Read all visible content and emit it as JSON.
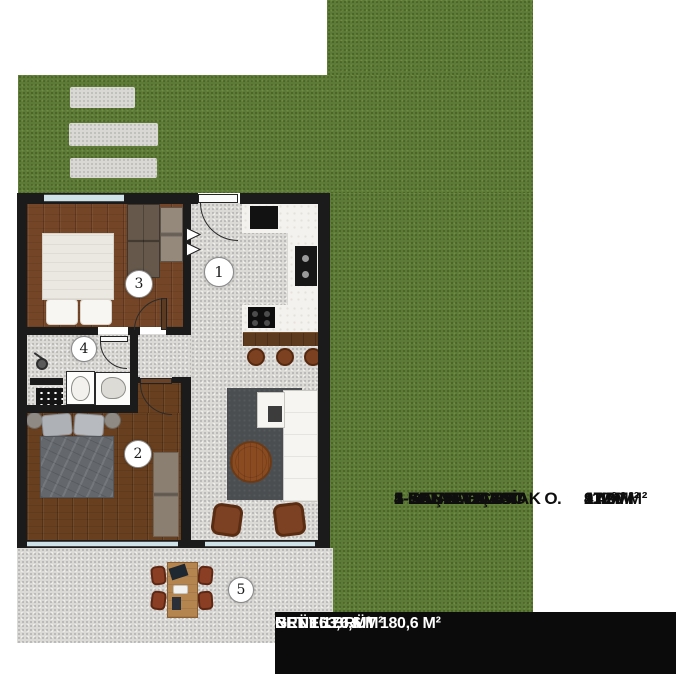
{
  "plan": {
    "room_numbers": [
      "1",
      "2",
      "3",
      "4",
      "5"
    ],
    "palette": {
      "grass": "#5d7a36",
      "wall": "#1b1b1b",
      "floor_gray": "#dcdad7",
      "wood_light": "#744627",
      "wood_dark": "#69401f",
      "window_glass": "#cfe2e8",
      "kitchen_floor": "#f4f2ee",
      "summary_bg": "#0b0b0b"
    }
  },
  "legend": {
    "items": [
      {
        "name": "1- YAŞAM ALANI",
        "value": "27 M²"
      },
      {
        "name": "2-EBEVEYN YATAK O.",
        "value": "11.20 M²"
      },
      {
        "name": "3-YATAK ODASI",
        "value": "9.40 M²"
      },
      {
        "name": "4-GENEL BANYO",
        "value": "4 M²"
      },
      {
        "name": "5-KAT BAHÇESİ",
        "value": "112 M²"
      }
    ]
  },
  "summary": {
    "lines": [
      "NET 163,6 M²",
      "BRÜT 170,6 M²",
      "GENEL BRÜT 180,6 M²"
    ]
  }
}
